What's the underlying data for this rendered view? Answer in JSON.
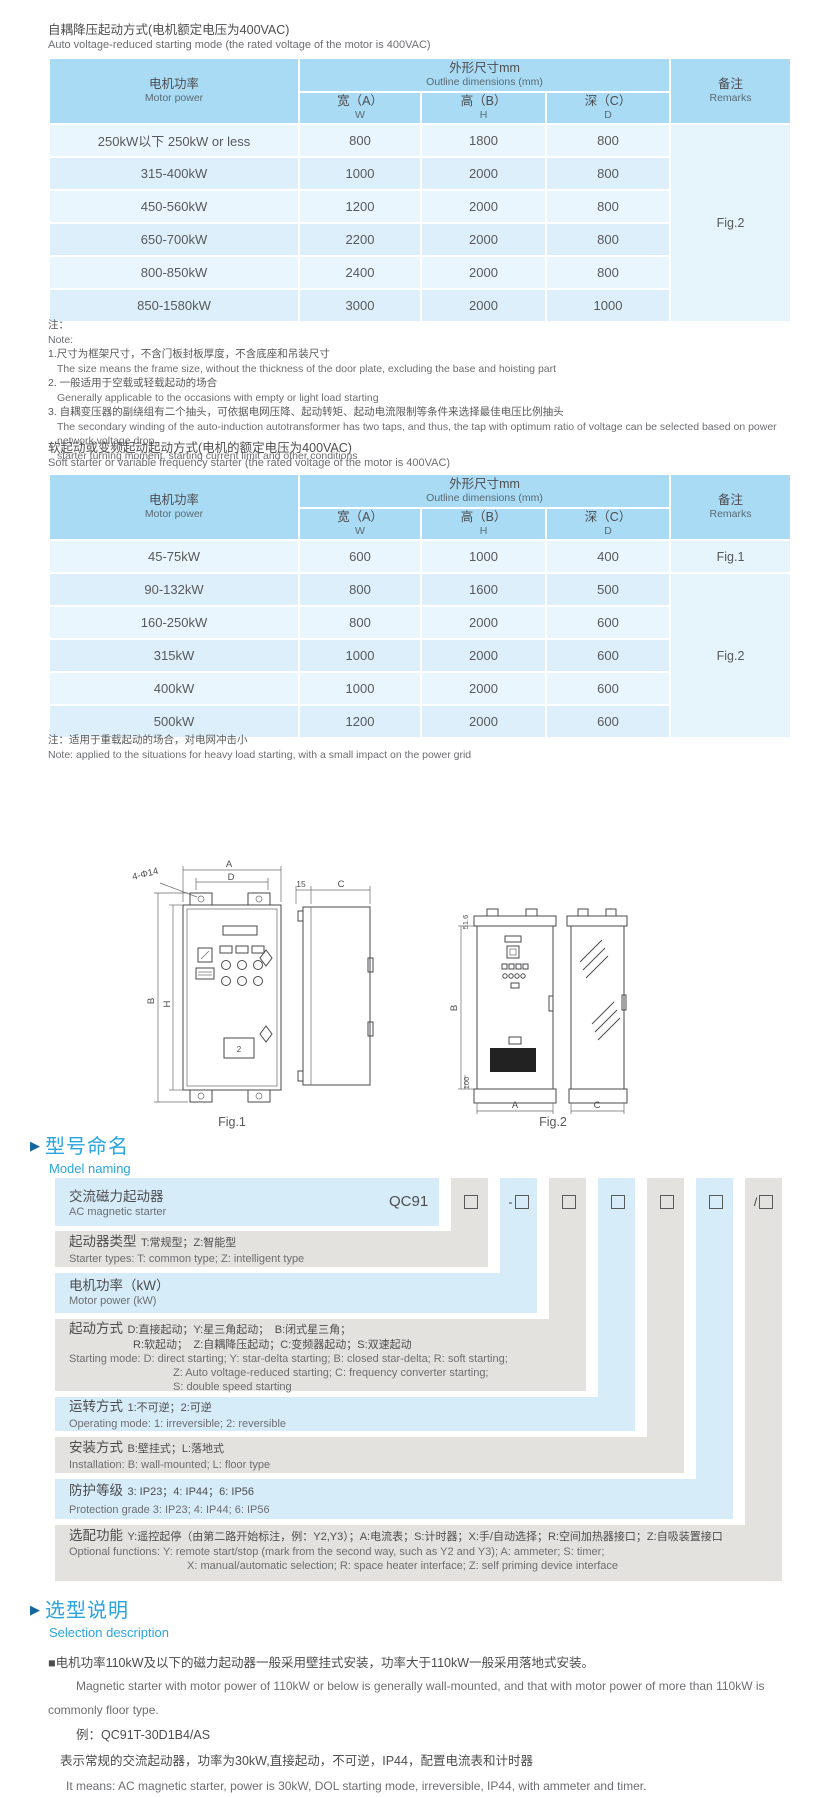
{
  "colors": {
    "accent": "#29a4dd",
    "table_header": "#a9dbf4",
    "row_light": "#eaf6fd",
    "row_dark": "#dceffa",
    "stripe_gray": "#e4e2de",
    "stripe_blue": "#d7ecf9"
  },
  "section1": {
    "title_cn": "自耦降压起动方式(电机额定电压为400VAC)",
    "title_en": "Auto voltage-reduced starting mode (the rated voltage of the motor is 400VAC)",
    "table": {
      "header": {
        "motor_cn": "电机功率",
        "motor_en": "Motor power",
        "outline_cn": "外形尺寸mm",
        "outline_en": "Outline dimensions (mm)",
        "w_cn": "宽（A）",
        "w_en": "W",
        "h_cn": "高（B）",
        "h_en": "H",
        "d_cn": "深（C）",
        "d_en": "D",
        "remark_cn": "备注",
        "remark_en": "Remarks"
      },
      "rows": [
        {
          "power": "250kW以下 250kW or less",
          "w": "800",
          "h": "1800",
          "d": "800"
        },
        {
          "power": "315-400kW",
          "w": "1000",
          "h": "2000",
          "d": "800"
        },
        {
          "power": "450-560kW",
          "w": "1200",
          "h": "2000",
          "d": "800"
        },
        {
          "power": "650-700kW",
          "w": "2200",
          "h": "2000",
          "d": "800"
        },
        {
          "power": "800-850kW",
          "w": "2400",
          "h": "2000",
          "d": "800"
        },
        {
          "power": "850-1580kW",
          "w": "3000",
          "h": "2000",
          "d": "1000"
        }
      ],
      "remark": "Fig.2"
    }
  },
  "notes1": {
    "label_cn": "注：",
    "label_en": "Note:",
    "item1_cn": "1.尺寸为框架尺寸，不含门板封板厚度，不含底座和吊装尺寸",
    "item1_en": "The size means the frame size, without the thickness of the door plate, excluding the base and hoisting part",
    "item2_cn": "2. 一般适用于空载或轻载起动的场合",
    "item2_en": "Generally applicable to the occasions with empty or light load starting",
    "item3_cn": "3. 自耦变压器的副绕组有二个抽头，可依据电网压降、起动转矩、起动电流限制等条件来选择最佳电压比例抽头",
    "item3_en": "The secondary winding of the auto-induction autotransformer has two taps, and thus, the tap with optimum ratio of voltage can be selected based on power network voltage drop,",
    "item3_en2": "starter turning moment, starting current limit and other conditions"
  },
  "section2": {
    "title_cn": "软起动或变频起动起动方式(电机的额定电压为400VAC)",
    "title_en": "Soft starter or variable frequency starter (the rated voltage of the motor is 400VAC)",
    "table": {
      "header": {
        "motor_cn": "电机功率",
        "motor_en": "Motor power",
        "outline_cn": "外形尺寸mm",
        "outline_en": "Outline dimensions (mm)",
        "w_cn": "宽（A）",
        "w_en": "W",
        "h_cn": "高（B）",
        "h_en": "H",
        "d_cn": "深（C）",
        "d_en": "D",
        "remark_cn": "备注",
        "remark_en": "Remarks"
      },
      "rows": [
        {
          "power": "45-75kW",
          "w": "600",
          "h": "1000",
          "d": "400"
        },
        {
          "power": "90-132kW",
          "w": "800",
          "h": "1600",
          "d": "500"
        },
        {
          "power": "160-250kW",
          "w": "800",
          "h": "2000",
          "d": "600"
        },
        {
          "power": "315kW",
          "w": "1000",
          "h": "2000",
          "d": "600"
        },
        {
          "power": "400kW",
          "w": "1000",
          "h": "2000",
          "d": "600"
        },
        {
          "power": "500kW",
          "w": "1200",
          "h": "2000",
          "d": "600"
        }
      ],
      "remark_first": "Fig.1",
      "remark_rest": "Fig.2"
    }
  },
  "note2": {
    "cn": "注：适用于重载起动的场合，对电网冲击小",
    "en": "Note: applied to the situations for heavy load starting, with a small impact on the power grid"
  },
  "figures": {
    "fig1": {
      "label": "Fig.1",
      "dim_a": "A",
      "dim_d": "D",
      "holes": "4-Φ14",
      "dim_b": "B",
      "dim_h": "H",
      "dim_15": "15",
      "dim_c": "C",
      "panel_num": "2"
    },
    "fig2": {
      "label": "Fig.2",
      "dim_516": "51.6",
      "dim_b": "B",
      "dim_100": "100",
      "dim_a": "A",
      "dim_c": "C"
    }
  },
  "model_naming": {
    "arrow": "▶",
    "heading_cn": "型号命名",
    "heading_en": "Model naming",
    "product_cn": "交流磁力起动器",
    "product_en": "AC magnetic starter",
    "code": "QC91",
    "box_prefixes": [
      "",
      "-",
      "",
      "",
      "",
      "",
      "/"
    ],
    "rows": [
      {
        "label": "起动器类型",
        "desc": "T:常规型；Z:智能型",
        "en": "Starter types: T: common type; Z: intelligent type"
      },
      {
        "label": "电机功率（kW）",
        "en": "Motor power (kW)"
      },
      {
        "label": "起动方式",
        "desc": "D:直接起动；Y:星三角起动；　B:闭式星三角；",
        "desc2": "R:软起动；　Z:自耦降压起动；C:变频器起动；S:双速起动",
        "en": "Starting mode: D: direct starting; Y: star-delta starting; B: closed star-delta; R: soft starting;",
        "en2": "Z: Auto voltage-reduced starting; C: frequency converter starting;",
        "en3": "S: double speed starting"
      },
      {
        "label": "运转方式",
        "desc": "1:不可逆；2:可逆",
        "en": "Operating mode: 1: irreversible; 2: reversible"
      },
      {
        "label": "安装方式",
        "desc": "B:壁挂式；L:落地式",
        "en": "Installation: B: wall-mounted; L: floor type"
      },
      {
        "label": "防护等级",
        "desc": "3: IP23；4: IP44；6: IP56",
        "en": "Protection grade  3: IP23; 4: IP44; 6: IP56"
      },
      {
        "label": "选配功能",
        "desc": "Y:遥控起停（由第二路开始标注，例：Y2,Y3）；A:电流表；S:计时器；X:手/自动选择；R:空间加热器接口；Z:自吸装置接口",
        "en": "Optional functions: Y: remote start/stop (mark from the second way, such as Y2 and Y3); A: ammeter; S: timer;",
        "en2": "X: manual/automatic selection; R: space heater interface; Z: self priming device interface"
      }
    ]
  },
  "selection": {
    "arrow": "▶",
    "heading_cn": "选型说明",
    "heading_en": "Selection description",
    "bullet": "■",
    "p1_cn": "电机功率110kW及以下的磁力起动器一般采用壁挂式安装，功率大于110kW一般采用落地式安装。",
    "p1_en": "Magnetic starter with motor power of 110kW or below is generally wall-mounted, and that with motor power of more than 110kW is commonly floor type.",
    "example": "例：QC91T-30D1B4/AS",
    "p2_cn": "表示常规的交流起动器，功率为30kW,直接起动，不可逆，IP44，配置电流表和计时器",
    "p2_en": "It means: AC magnetic starter, power is 30kW, DOL starting mode, irreversible, IP44, with ammeter and timer."
  }
}
